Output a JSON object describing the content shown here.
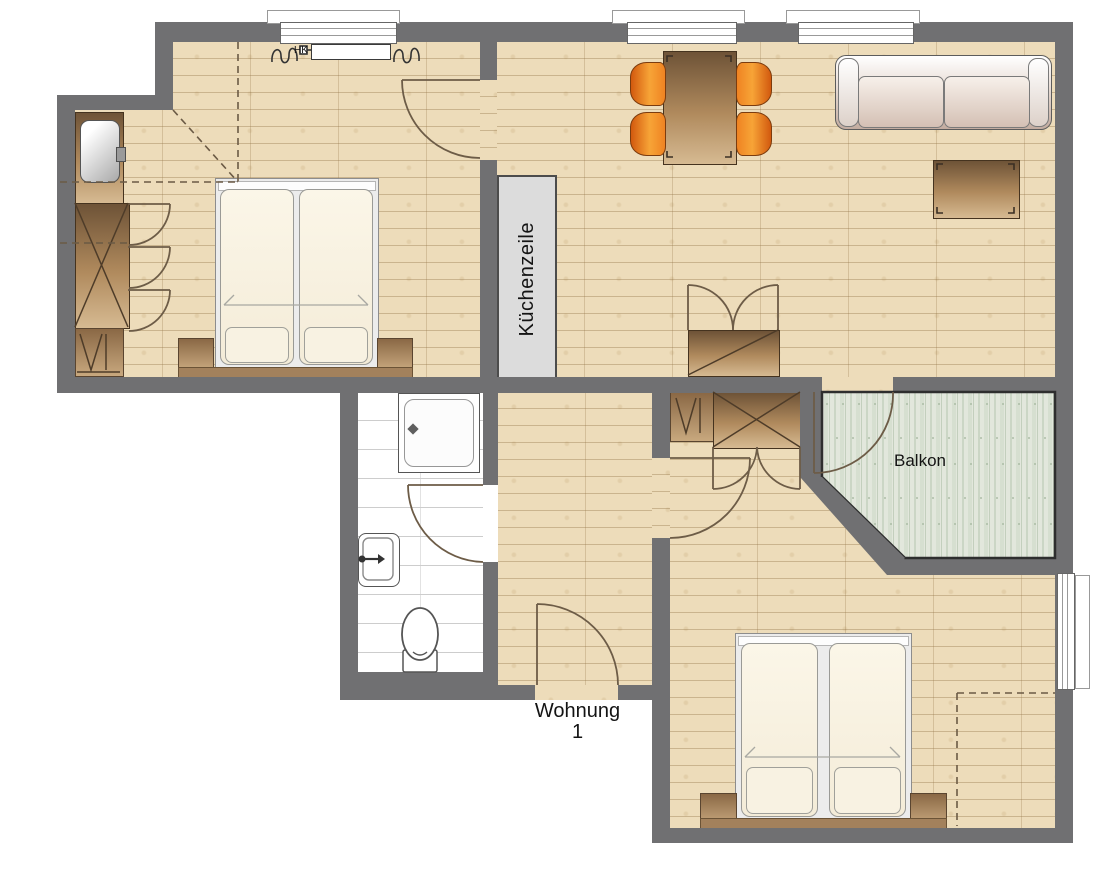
{
  "plan": {
    "labels": {
      "kitchen_unit": "Küchenzeile",
      "balcony": "Balkon",
      "apartment_line1": "Wohnung",
      "apartment_line2": "1",
      "radiator": "HK"
    },
    "colors": {
      "wall": "#707072",
      "wood_floor": "#eddcba",
      "balcony_floor": "#e2e7dc",
      "bathroom_floor": "#ffffff",
      "kitchen_unit": "#dcdcdc",
      "furniture_brown": "#8a6845",
      "chair_orange": "#f7a437",
      "door_swing": "#6d5c47"
    }
  }
}
